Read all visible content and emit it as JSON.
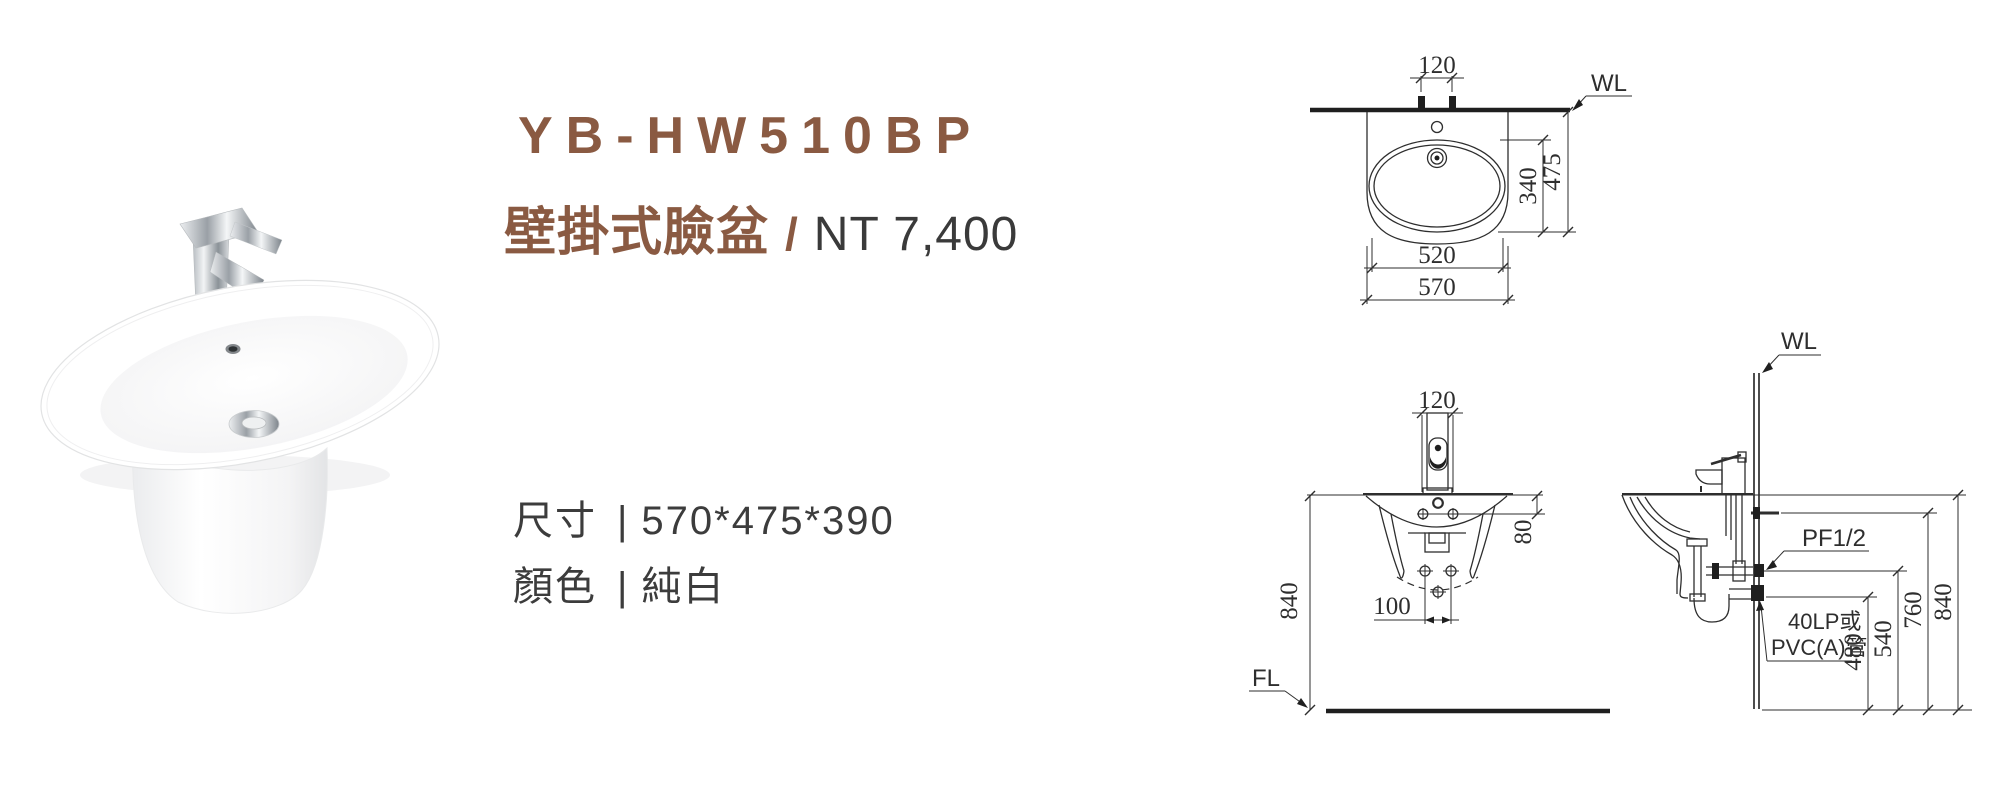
{
  "product": {
    "model": "YB-HW510BP",
    "category": "壁掛式臉盆",
    "separator": "/",
    "price": "NT 7,400",
    "spec_size_label": "尺寸",
    "spec_size_divider": "|",
    "spec_size_value": "570*475*390",
    "spec_color_label": "顏色",
    "spec_color_divider": "|",
    "spec_color_value": "純白"
  },
  "colors": {
    "accent_brown": "#8a5a42",
    "text_dark": "#3a3a3a",
    "drawing_line": "#2e2e2e"
  },
  "plan_view": {
    "wall_label": "WL",
    "dim_faucet_spacing": "120",
    "dim_bowl_depth": "340",
    "dim_overall_depth": "475",
    "dim_bowl_width": "520",
    "dim_overall_width": "570"
  },
  "front_view": {
    "dim_faucet_spacing": "120",
    "dim_rim_to_holes": "80",
    "dim_rim_height": "840",
    "dim_anchor_spacing": "100",
    "floor_label": "FL"
  },
  "side_view": {
    "wall_label": "WL",
    "supply_spec": "PF1/2",
    "drain_note_line1": "40LP或",
    "drain_note_line2": "PVC(A)管",
    "dim_drain_height": "480",
    "dim_supply_height": "540",
    "dim_anchor_height": "760",
    "dim_rim_height": "840"
  }
}
